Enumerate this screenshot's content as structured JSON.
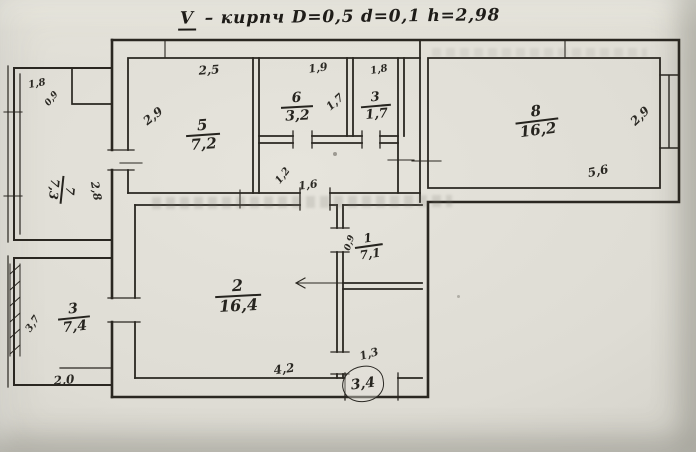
{
  "document": {
    "title": {
      "numeral": "V",
      "text": "– кирпч   D=0,5  d=0,1  h=2,98"
    }
  },
  "plan": {
    "ink_color": "#2a2721",
    "rooms": [
      {
        "number": "5",
        "area": "7,2",
        "x": 203,
        "y": 135,
        "rot": -4,
        "size": 15
      },
      {
        "number": "6",
        "area": "3,2",
        "x": 297,
        "y": 107,
        "rot": -3,
        "size": 14
      },
      {
        "number": "3",
        "area": "1,7",
        "x": 376,
        "y": 106,
        "rot": -5,
        "size": 13
      },
      {
        "number": "8",
        "area": "16,2",
        "x": 537,
        "y": 121,
        "rot": -7,
        "size": 15
      },
      {
        "number": "2",
        "area": "16,4",
        "x": 238,
        "y": 296,
        "rot": -3,
        "size": 16
      },
      {
        "number": "1",
        "area": "7,1",
        "x": 369,
        "y": 246,
        "rot": -8,
        "size": 12
      },
      {
        "number": "7",
        "area": "7,3",
        "x": 62,
        "y": 190,
        "rot": 96,
        "size": 12
      },
      {
        "number": "3",
        "area": "7,4",
        "x": 74,
        "y": 318,
        "rot": -6,
        "size": 14
      }
    ],
    "dimensions": [
      {
        "text": "2,5",
        "x": 209,
        "y": 70,
        "rot": -4,
        "size": 12
      },
      {
        "text": "1,9",
        "x": 318,
        "y": 68,
        "rot": -8,
        "size": 11
      },
      {
        "text": "1,8",
        "x": 379,
        "y": 70,
        "rot": -10,
        "size": 10
      },
      {
        "text": "2,9",
        "x": 153,
        "y": 116,
        "rot": -38,
        "size": 12
      },
      {
        "text": "1,7",
        "x": 335,
        "y": 102,
        "rot": -42,
        "size": 11
      },
      {
        "text": "2,9",
        "x": 640,
        "y": 116,
        "rot": -44,
        "size": 12
      },
      {
        "text": "5,6",
        "x": 598,
        "y": 171,
        "rot": -12,
        "size": 12
      },
      {
        "text": "2,8",
        "x": 96,
        "y": 191,
        "rot": 80,
        "size": 11
      },
      {
        "text": "1,8",
        "x": 37,
        "y": 84,
        "rot": -10,
        "size": 10
      },
      {
        "text": "0,9",
        "x": 52,
        "y": 99,
        "rot": -52,
        "size": 9
      },
      {
        "text": "1,2",
        "x": 283,
        "y": 176,
        "rot": -52,
        "size": 10
      },
      {
        "text": "1,6",
        "x": 308,
        "y": 185,
        "rot": -8,
        "size": 11
      },
      {
        "text": "0,9",
        "x": 350,
        "y": 243,
        "rot": -72,
        "size": 9
      },
      {
        "text": "3,7",
        "x": 33,
        "y": 324,
        "rot": -56,
        "size": 10
      },
      {
        "text": "2,0",
        "x": 64,
        "y": 380,
        "rot": -5,
        "size": 12
      },
      {
        "text": "4,2",
        "x": 284,
        "y": 369,
        "rot": -8,
        "size": 12
      },
      {
        "text": "1,3",
        "x": 369,
        "y": 354,
        "rot": -16,
        "size": 11
      }
    ],
    "entrance": {
      "text": "3,4"
    }
  }
}
